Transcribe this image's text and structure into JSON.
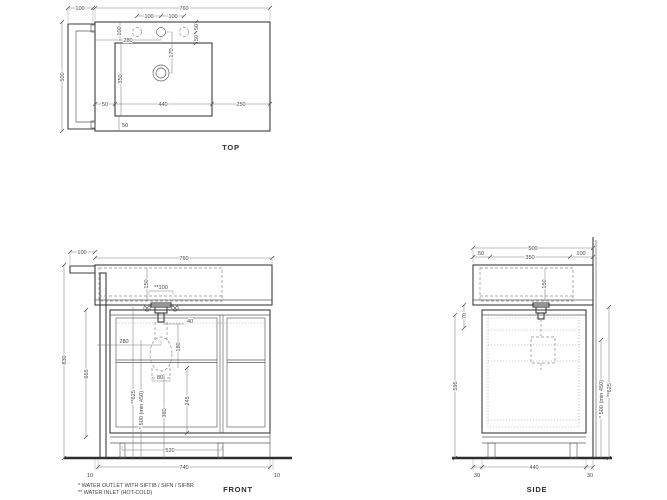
{
  "views": {
    "top": {
      "label": "TOP",
      "d": {
        "rail": "100",
        "width": "760",
        "holes_l": "100",
        "holes_r": "100",
        "depth": "500",
        "hole_top": "100",
        "tap_left": "280",
        "r50a": "50",
        "r50b": "50",
        "drain": "170",
        "basin_d": "350",
        "m_left": "50",
        "basin_w": "440",
        "m_right": "250",
        "m_front": "50"
      }
    },
    "front": {
      "label": "FRONT",
      "d": {
        "rail": "100",
        "width": "760",
        "basin_h": "150",
        "inlet_w": "**100",
        "total_h": "830",
        "box_h": "665",
        "g40": "40",
        "siph_x": "280",
        "drop": "180",
        "trap": "80",
        "inlet_h": "**625",
        "outlet_h": "* 500 (min 450)",
        "d245": "245",
        "d360": "360",
        "plinth": "520",
        "base": "740",
        "off_l": "10",
        "off_r": "10"
      }
    },
    "side": {
      "label": "SIDE",
      "d": {
        "depth": "500",
        "f50": "50",
        "mid350": "350",
        "b100": "100",
        "basin_h": "150",
        "g70": "70",
        "box_h": "595",
        "outlet_h": "* 500 (min 450)",
        "inlet_h": "**625",
        "f30": "30",
        "base440": "440",
        "b30": "30"
      }
    }
  },
  "footnotes": {
    "line1": "*  WATER OUTLET WITH SIFTIB / SIFN / SIFBR",
    "line2": "** WATER INLET (HOT-COLD)"
  }
}
